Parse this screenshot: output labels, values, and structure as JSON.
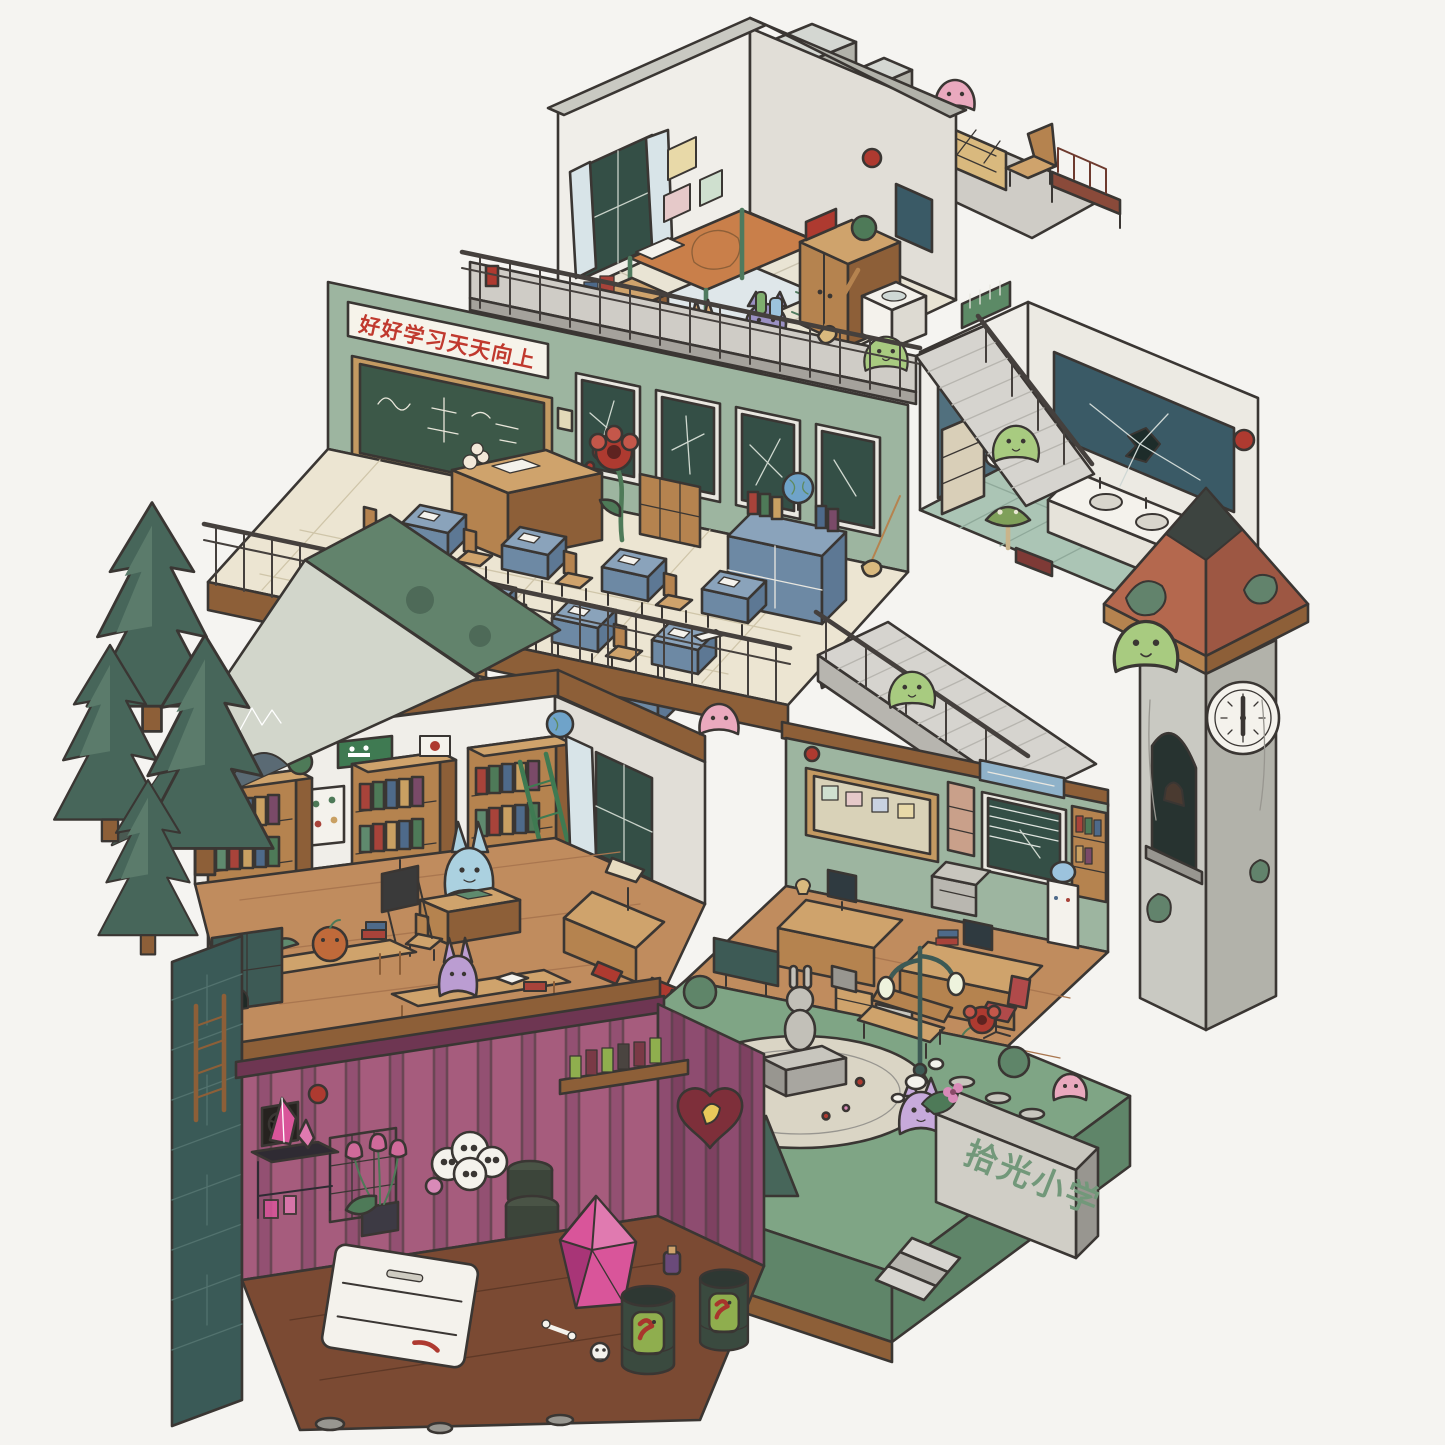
{
  "texts": {
    "classroom_banner": "好好学习天天向上",
    "school_sign": "拾光小学"
  },
  "clock": {
    "time_approx": "6:00"
  },
  "icons": {
    "exit_sign": "green running-figure exit plaque",
    "clock_face": "white clock with dark hands",
    "vent_fan": "dark wall fan grille",
    "crack_star": "star-shaped crack on mirror"
  },
  "scene": {
    "rooms": [
      "rooftop-terrace",
      "dorm-bedroom",
      "bathroom",
      "classroom",
      "library",
      "teachers-office",
      "courtyard",
      "clock-tower",
      "basement-lab",
      "school-gate"
    ]
  },
  "colors": {
    "bg": "#f5f4f1",
    "outline": "#3a3633",
    "wall_white": "#f0eee9",
    "wall_shade": "#e1ded7",
    "wall_green": "#9db5a0",
    "glass_dark": "#344f46",
    "window_frame": "#e9e7e0",
    "banner_white": "#f6f3ea",
    "banner_red": "#c0392e",
    "board_green": "#3c5848",
    "board_frame": "#c49a62",
    "wood": "#b5834f",
    "wood_dark": "#8d5f38",
    "wood_light": "#cfa36c",
    "floor_tile": "#ece5d2",
    "floor_wood": "#c08c5e",
    "desk_blue": "#8aa3bb",
    "desk_blue_mid": "#6d89a4",
    "desk_blue_dark": "#5d7894",
    "railing": "#45403d",
    "slab": "#cfccc6",
    "slab_dark": "#a5a29c",
    "stair": "#d6d4cf",
    "stair_dark": "#b7b5af",
    "tile_teal": "#abc5b5",
    "mirror_teal": "#3a5a66",
    "porcelain": "#f4f2ec",
    "tower_gray": "#c9c9c2",
    "tower_gray_dark": "#b2b2aa",
    "roof_clay": "#b4684e",
    "roof_clay_dark": "#9d5743",
    "roof_moss": "#62836c",
    "roof_dark": "#3d4440",
    "grass": "#7fa585",
    "grass_dark": "#5f8569",
    "plaza": "#dad5c5",
    "stone": "#c8c6be",
    "stone_dark": "#989690",
    "tree": "#47665a",
    "tree2": "#5b7b6b",
    "leaf": "#4e7a58",
    "pink_wall": "#a65c7d",
    "pink_wall_dark": "#84476a",
    "basement_floor": "#7b4a33",
    "crystal": "#d9559a",
    "crystal_dark": "#a83577",
    "jar_green": "#8fae4e",
    "slime": "#a8cb80",
    "ghost_pink": "#eaa9be",
    "ghost_blue": "#abd1e0",
    "ghost_purple": "#bb9dd2",
    "accent_red": "#ae3a30",
    "brass": "#d9b97e",
    "teal_dark": "#3d5a55",
    "sign_text": "#72987a",
    "curtain": "#d8e4e8"
  }
}
